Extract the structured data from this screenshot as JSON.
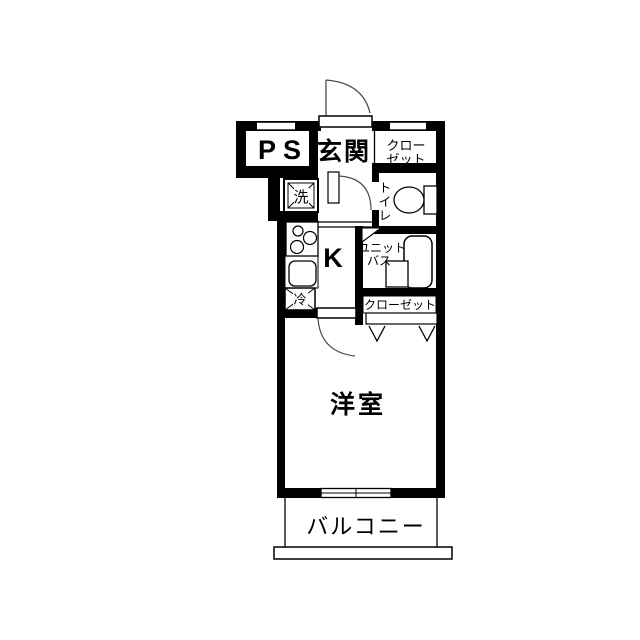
{
  "rooms": {
    "ps": {
      "label": "PS"
    },
    "entrance": {
      "label": "玄関"
    },
    "upper_closet": {
      "line1": "クロー",
      "line2": "ゼット"
    },
    "toilet": {
      "chars": [
        "ト",
        "イ",
        "レ"
      ]
    },
    "kitchen": {
      "label": "K"
    },
    "unit_bath": {
      "line1": "ユニット",
      "line2": "バス"
    },
    "lower_closet": {
      "label": "クローゼット"
    },
    "western_room": {
      "label": "洋室"
    },
    "balcony": {
      "label": "バルコニー"
    }
  },
  "fixtures": {
    "washer": {
      "label": "洗"
    },
    "fridge": {
      "label": "冷"
    }
  },
  "colors": {
    "wall": "#000000",
    "door_arc": "#4a4a4a",
    "background": "#ffffff"
  }
}
